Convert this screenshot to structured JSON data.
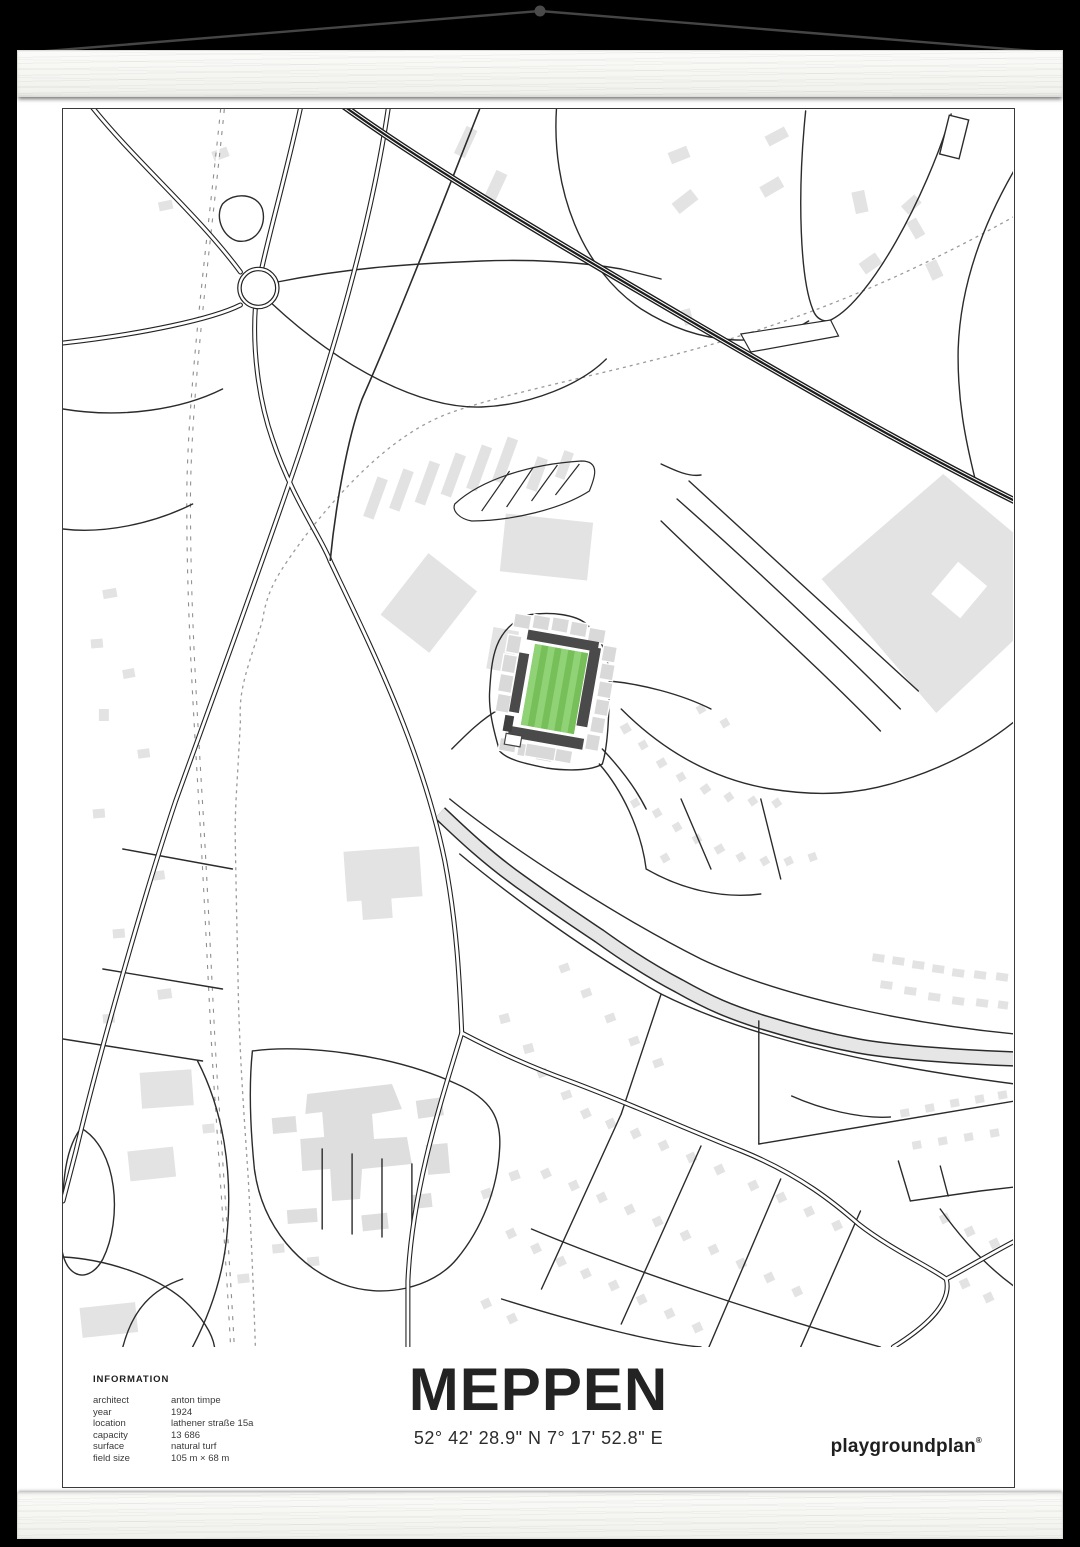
{
  "poster": {
    "title": "MEPPEN",
    "coordinates": "52° 42' 28.9\" N 7° 17' 52.8\" E",
    "brand": "playgroundplan",
    "brand_mark": "®",
    "info": {
      "heading": "INFORMATION",
      "rows": [
        {
          "label": "architect",
          "value": "anton timpe"
        },
        {
          "label": "year",
          "value": "1924"
        },
        {
          "label": "location",
          "value": "lathener straße 15a"
        },
        {
          "label": "capacity",
          "value": "13 686"
        },
        {
          "label": "surface",
          "value": "natural turf"
        },
        {
          "label": "field size",
          "value": "105 m × 68 m"
        }
      ]
    },
    "colors": {
      "background": "#000000",
      "paper": "#ffffff",
      "wood_bar": "#f5f5f1",
      "map_line": "#222222",
      "building_gray": "#e3e3e3",
      "stand_dark": "#4a4a4a",
      "stand_light": "#d9d9d9",
      "pitch_green": "#82c763",
      "pitch_stripe_light": "#90d276",
      "pitch_stripe_dark": "#77bf58"
    }
  }
}
